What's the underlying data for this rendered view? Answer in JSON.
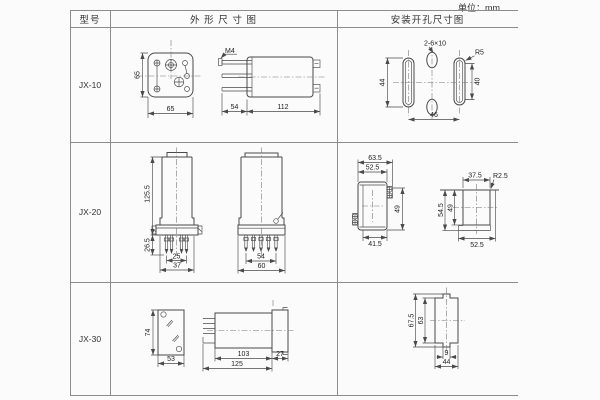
{
  "unit_label": "单位：mm",
  "headers": {
    "model": "型号",
    "outline": "外 形 尺 寸 图",
    "mounting": "安装开孔尺寸图"
  },
  "colors": {
    "drawing_line": "#4a4a4a",
    "table_border": "#8c8c8c",
    "text": "#333333",
    "background": "#fbfbfb"
  },
  "jx10": {
    "model": "JX-10",
    "front": {
      "height": "65",
      "width": "65"
    },
    "side": {
      "screw": "M4",
      "pin_len": "54",
      "body_len": "112"
    },
    "mount": {
      "holes": "2-6×10",
      "radius": "R5",
      "left_h": "44",
      "right_h": "40",
      "width": "46"
    }
  },
  "jx20": {
    "model": "JX-20",
    "front": {
      "height": "125.5",
      "pin_h": "26.5",
      "pin_w": "25",
      "base_w": "37"
    },
    "side": {
      "pin_w": "54",
      "base_w": "60"
    },
    "mount_a": {
      "outer_w": "63.5",
      "inner_w": "52.5",
      "height": "49",
      "bottom_w": "41.5"
    },
    "mount_b": {
      "top_w": "37.5",
      "radius": "R2.5",
      "outer_h": "54.5",
      "inner_h": "49",
      "bottom_w": "52.5"
    }
  },
  "jx30": {
    "model": "JX-30",
    "front": {
      "height": "74",
      "width": "53"
    },
    "side": {
      "body_len": "103",
      "socket_len": "27",
      "total_len": "125"
    },
    "mount": {
      "outer_h": "67.5",
      "inner_h": "63",
      "slot_w": "9",
      "width": "44"
    }
  }
}
